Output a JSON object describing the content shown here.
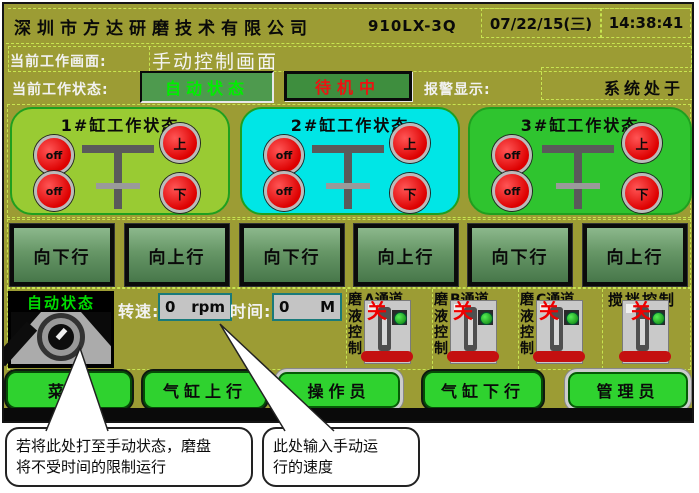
{
  "header": {
    "company": "深圳市方达研磨技术有限公司",
    "model": "910LX-3Q",
    "date": "07/22/15(三)",
    "time": "14:38:41"
  },
  "current_screen": {
    "label": "当前工作画面:",
    "value": "手动控制画面"
  },
  "status": {
    "label": "当前工作状态:",
    "mode": "自动状态",
    "standby": "待机中",
    "alarm_label": "报警显示:",
    "alarm_text": "系统处于"
  },
  "cylinders": [
    {
      "title": "1#缸工作状态",
      "lamps": [
        "off",
        "off",
        "上",
        "下"
      ]
    },
    {
      "title": "2#缸工作状态",
      "lamps": [
        "off",
        "off",
        "上",
        "下"
      ]
    },
    {
      "title": "3#缸工作状态",
      "lamps": [
        "off",
        "off",
        "上",
        "下"
      ]
    }
  ],
  "motion_buttons": [
    "向下行",
    "向上行",
    "向下行",
    "向上行",
    "向下行",
    "向上行"
  ],
  "manual": {
    "knob_state": "自动状态",
    "speed_label": "转速:",
    "speed_value": "0",
    "speed_unit": "rpm",
    "time_label": "时间:",
    "time_value": "0",
    "time_unit": "M"
  },
  "channels": [
    {
      "prefix": "磨",
      "name": "A通道",
      "col": [
        "液",
        "控",
        "制"
      ],
      "state": "关"
    },
    {
      "prefix": "磨",
      "name": "B通道",
      "col": [
        "液",
        "控",
        "制"
      ],
      "state": "关"
    },
    {
      "prefix": "磨",
      "name": "C通道",
      "col": [
        "液",
        "控",
        "制"
      ],
      "state": "关"
    }
  ],
  "stir": {
    "label": "搅拌控制",
    "state": "关"
  },
  "bottom_buttons": [
    {
      "label": "菜单"
    },
    {
      "label": "气缸上行"
    },
    {
      "label": "操作员"
    },
    {
      "label": "气缸下行"
    },
    {
      "label": "管理员"
    }
  ],
  "callouts": [
    {
      "line1": "若将此处打至手动状态，磨盘",
      "line2": "将不受时间的限制运行"
    },
    {
      "line1": "此处输入手动运",
      "line2": "行的速度"
    }
  ],
  "colors": {
    "screen_bg": "#9C9C34",
    "panel1_bg": "#99CB33",
    "panel2_bg": "#00E6E6",
    "panel3_bg": "#2FC42F",
    "lamp_red": "#DD0000",
    "mode_text": "#00EE00",
    "standby_text": "#EE1111",
    "bottom_button_green": "#2FD22F",
    "off_state_red": "#EE0000",
    "dash_line": "#C8E550"
  }
}
